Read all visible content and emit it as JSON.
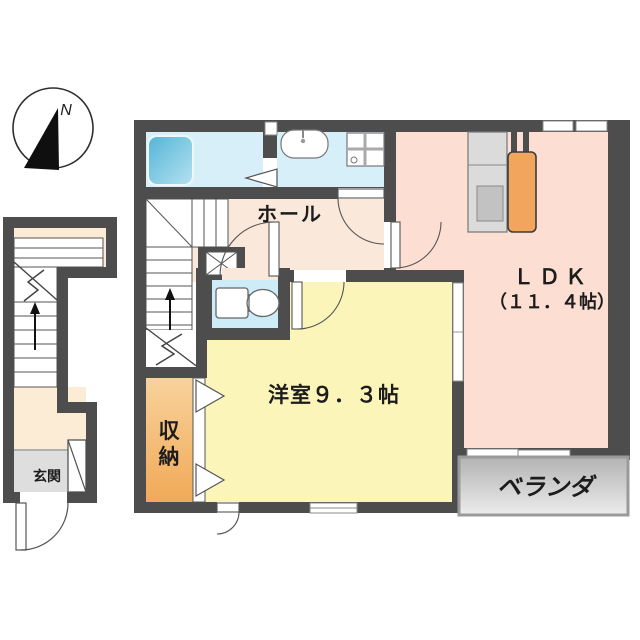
{
  "compass": {
    "north_label": "N"
  },
  "annex": {
    "entrance_label": "玄関"
  },
  "rooms": {
    "hall": {
      "label": "ホール"
    },
    "ldk": {
      "label": "ＬＤＫ",
      "size": "（１１．４帖）"
    },
    "western_room": {
      "label": "洋室９．３帖"
    },
    "storage": {
      "label": "収納",
      "char1": "収",
      "char2": "納"
    },
    "veranda": {
      "label": "ベランダ"
    }
  },
  "colors": {
    "wall": "#4d4d4d",
    "ldk_floor": "#fcdfd2",
    "hall_floor": "#fae8da",
    "western_room_floor": "#fbf5ba",
    "bathroom_floor": "#d6eff8",
    "toilet_floor": "#cdecf7",
    "annex_floor": "#fcecd5",
    "genkan_floor": "#dedede",
    "storage_gradient_top": "#f8d29c",
    "storage_gradient_bottom": "#f1a958",
    "tub_gradient_from": "#55b4d8",
    "tub_gradient_to": "#b5e2f0",
    "fridge": "#f2a55c",
    "kitchen_counter": "#dbdbdb",
    "kitchen_sink": "#c2c2c2",
    "veranda_gradient_top": "#b3b3b3",
    "veranda_gradient_bottom": "#ececec",
    "text": "#1c1c1c"
  }
}
